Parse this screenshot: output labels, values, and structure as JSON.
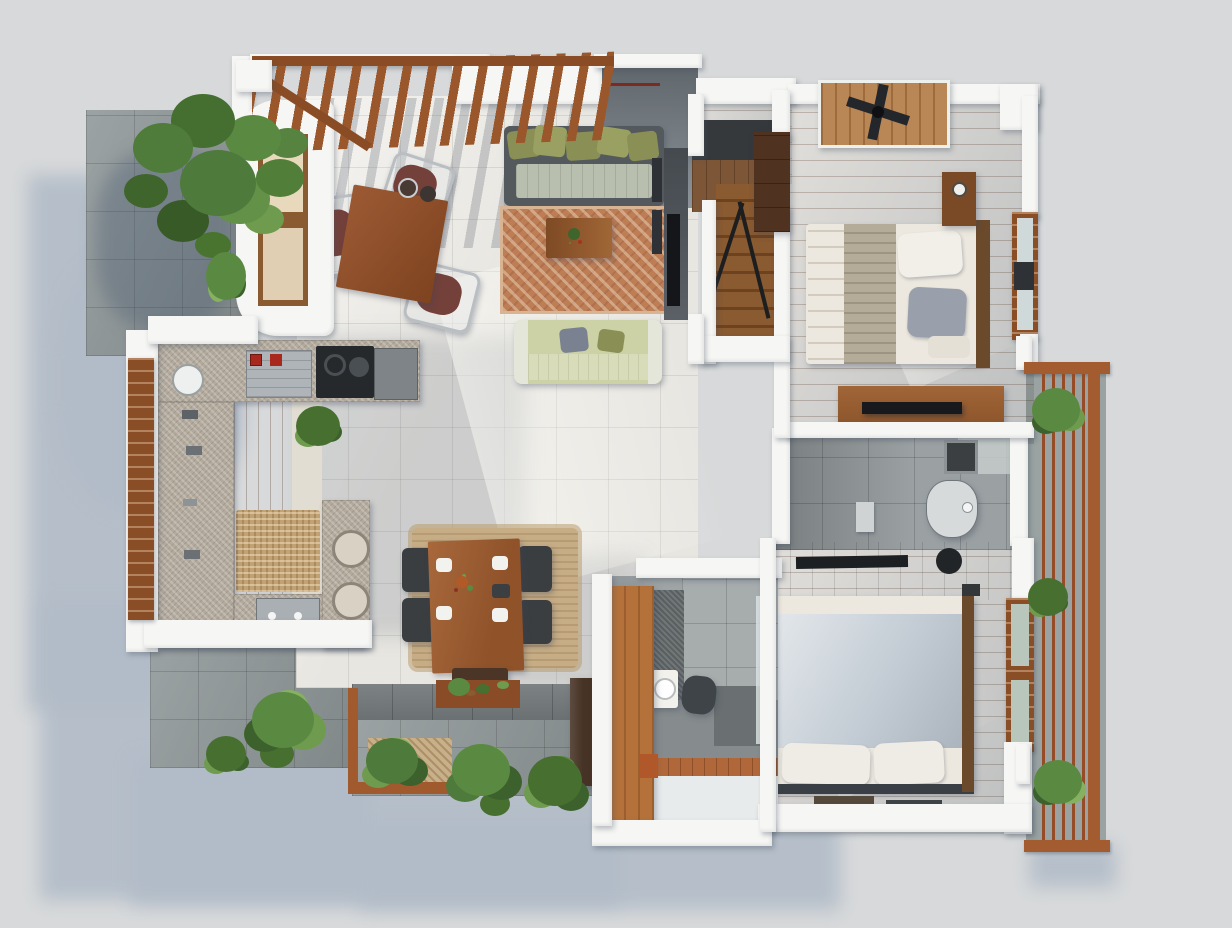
{
  "scene": {
    "type": "3d-floor-plan-top-view-render",
    "description": "Photorealistic top-down render of a two-bedroom house with pergola terrace, living room, kitchen, dining area, staircase, two bedrooms, toilet, bathroom, side balcony and garden patios",
    "rooms": [
      {
        "id": "pergola-terrace",
        "items": [
          "pergola",
          "breakfast-table",
          "chairs",
          "bay-window"
        ]
      },
      {
        "id": "living-room",
        "items": [
          "sofa",
          "coffee-table",
          "patterned-rug",
          "loveseat",
          "wall-tv"
        ]
      },
      {
        "id": "kitchen",
        "items": [
          "u-shaped-granite-counter",
          "cooktop",
          "steel-sink",
          "bar-stools",
          "rattan-mat",
          "louver-window"
        ]
      },
      {
        "id": "dining-area",
        "items": [
          "wood-dining-table",
          "chairs",
          "bench",
          "jute-rug",
          "place-settings",
          "centerpiece"
        ]
      },
      {
        "id": "staircase",
        "items": [
          "wood-steps",
          "black-railing",
          "landing"
        ]
      },
      {
        "id": "bedroom-1",
        "items": [
          "double-bed",
          "throw-blanket",
          "pillows",
          "nightstand",
          "desk",
          "tv",
          "wardrobe",
          "ceiling-fan-deck",
          "window"
        ]
      },
      {
        "id": "toilet-room",
        "items": [
          "toilet",
          "floor-drain"
        ]
      },
      {
        "id": "bathroom",
        "items": [
          "washbasin",
          "dark-vanity",
          "mosaic-wall",
          "wood-door",
          "threshold"
        ]
      },
      {
        "id": "bedroom-2",
        "items": [
          "double-bed",
          "blue-duvet",
          "pillows",
          "wood-console",
          "window",
          "floor-mats"
        ]
      },
      {
        "id": "balcony",
        "items": [
          "wood-slat-railing",
          "stone-floor",
          "planters"
        ]
      },
      {
        "id": "garden",
        "items": [
          "tree",
          "ferns",
          "planter-boxes",
          "stone-paving",
          "flower-box"
        ]
      }
    ],
    "palette": {
      "bg": "#d7d9da",
      "shadow": "#b2bcc8",
      "wall": "#f6f6f4",
      "floor": "#e8e6e1",
      "wood": "#9e5a31",
      "woodhi": "#b06a3a",
      "woodlo": "#8f4f28",
      "trimwood": "#8a4e27",
      "pergola": "#9a572b",
      "granite": "#b3aa9d",
      "stone": "#8e9697",
      "stonewall": "#6b7173",
      "rug": "#bd7d55",
      "jute": "#c7ad85",
      "sofaframe": "#54595e",
      "cushion": "#8a9055",
      "seat": "#b9bfae",
      "loveseat": "#ccd1a6",
      "tablewood": "#a8683c",
      "bedwhite": "#ece8df",
      "throw": "#b5ab99",
      "pillowgray": "#9aa0ab",
      "bed2": "#c3ccd4",
      "framedark": "#3a3f45",
      "plant": "#4e7a3c",
      "planthi": "#6f9b4f",
      "bathtile": "#9ba1a3",
      "bathfloor": "#868c8d",
      "mosaic": "#5a5f61",
      "steel": "#aeb4b8",
      "dark": "#26292c",
      "doorwood": "#b5713a",
      "glass": "#cfd9d9",
      "red": "#7e2a20"
    }
  }
}
